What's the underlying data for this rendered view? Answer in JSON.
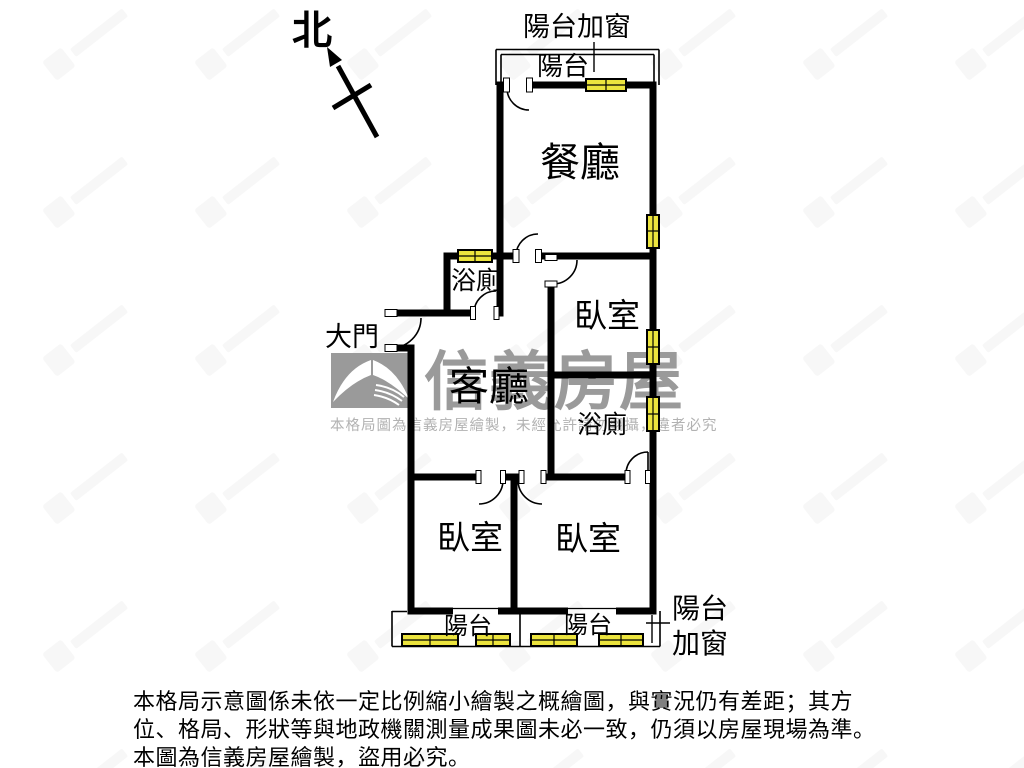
{
  "compass": {
    "north_label": "北"
  },
  "floor_plan": {
    "labels": {
      "balcony_top_note": "陽台加窗",
      "balcony_top": "陽台",
      "dining": "餐廳",
      "bath_upper": "浴廁",
      "bedroom_upper": "臥室",
      "entrance": "大門",
      "living": "客廳",
      "bath_lower": "浴廁",
      "bedroom_left": "臥室",
      "bedroom_right": "臥室",
      "balcony_bottom_left": "陽台",
      "balcony_bottom_right": "陽台",
      "balcony_right_note_line1": "陽台",
      "balcony_right_note_line2": "加窗"
    },
    "colors": {
      "wall": "#000000",
      "window_fill": "#ece43e",
      "watermark_gray": "#9a9a9a",
      "watermark_light": "#b2b2b2"
    }
  },
  "watermark": {
    "brand": "信義房屋",
    "notice": "本格局圖為信義房屋繪製，未經允許請勿翻攝，違者必究"
  },
  "disclaimer": {
    "line1": "本格局示意圖係未依一定比例縮小繪製之概繪圖，與實況仍有差距；其方",
    "line2": "位、格局、形狀等與地政機關測量成果圖未必一致，仍須以房屋現場為準。",
    "line3": "本圖為信義房屋繪製，盜用必究。"
  }
}
